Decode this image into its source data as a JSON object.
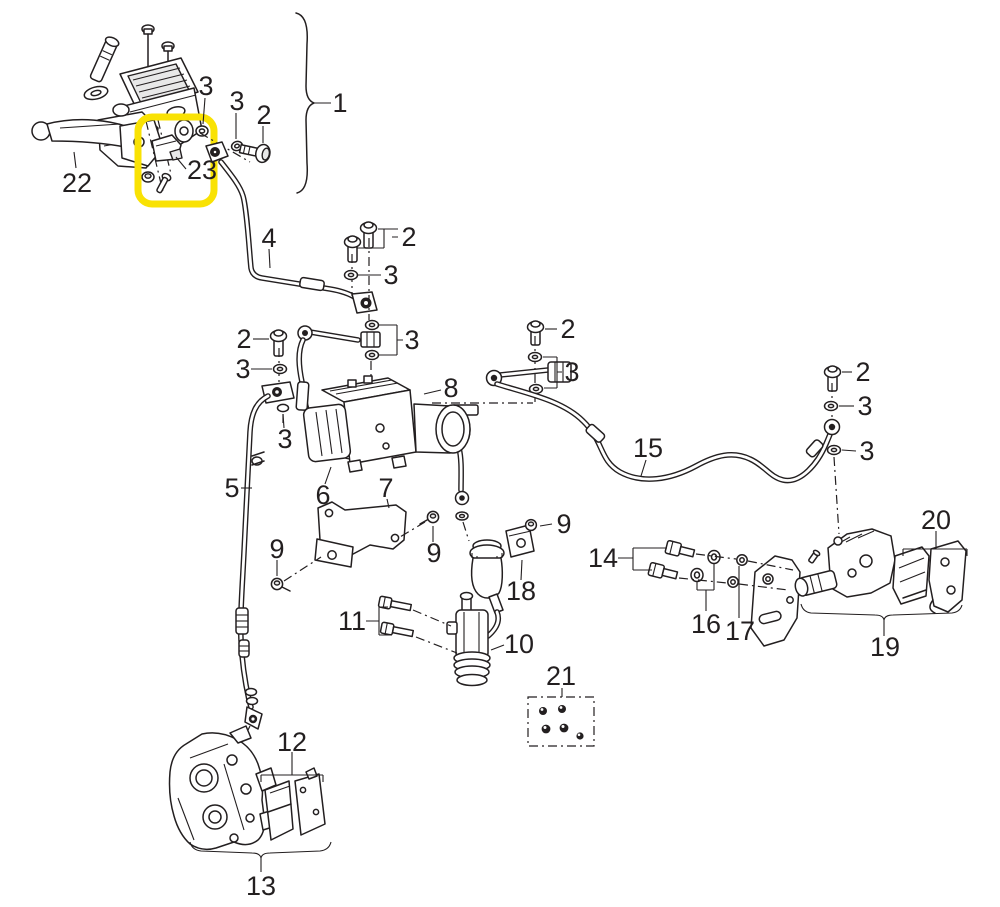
{
  "diagram": {
    "kind": "exploded-parts-diagram",
    "subject": "motorcycle hydraulic brake system with ABS",
    "background_color": "#ffffff",
    "line_color": "#231f20",
    "highlight": {
      "color": "#f9e204",
      "highlighted_part_label": "23",
      "highlighted_part": "brake-light-switch"
    },
    "callouts": [
      {
        "label": "1",
        "part": "front-master-cylinder-assembly"
      },
      {
        "label": "3",
        "part": "sealing-washer"
      },
      {
        "label": "3",
        "part": "sealing-washer"
      },
      {
        "label": "2",
        "part": "banjo-bolt"
      },
      {
        "label": "22",
        "part": "brake-lever"
      },
      {
        "label": "23",
        "part": "brake-light-switch"
      },
      {
        "label": "4",
        "part": "front-brake-hose-upper"
      },
      {
        "label": "2",
        "part": "banjo-bolt-pair"
      },
      {
        "label": "3",
        "part": "sealing-washer"
      },
      {
        "label": "3",
        "part": "sealing-washer-pair"
      },
      {
        "label": "2",
        "part": "banjo-bolt"
      },
      {
        "label": "3",
        "part": "sealing-washer"
      },
      {
        "label": "3",
        "part": "sealing-washer"
      },
      {
        "label": "8",
        "part": "mid-brake-hose"
      },
      {
        "label": "2",
        "part": "banjo-bolt"
      },
      {
        "label": "3",
        "part": "sealing-washer-pair"
      },
      {
        "label": "15",
        "part": "rear-brake-hose"
      },
      {
        "label": "2",
        "part": "banjo-bolt"
      },
      {
        "label": "3",
        "part": "sealing-washer"
      },
      {
        "label": "3",
        "part": "sealing-washer"
      },
      {
        "label": "5",
        "part": "front-brake-hose-lower"
      },
      {
        "label": "6",
        "part": "abs-modulator"
      },
      {
        "label": "7",
        "part": "abs-modulator-bracket"
      },
      {
        "label": "9",
        "part": "screw"
      },
      {
        "label": "9",
        "part": "screw"
      },
      {
        "label": "9",
        "part": "screw"
      },
      {
        "label": "18",
        "part": "reservoir-bracket"
      },
      {
        "label": "10",
        "part": "rear-master-cylinder"
      },
      {
        "label": "11",
        "part": "mounting-bolt-pair"
      },
      {
        "label": "14",
        "part": "caliper-mount-bolt-pair"
      },
      {
        "label": "16",
        "part": "washer-pair"
      },
      {
        "label": "17",
        "part": "nut-pair"
      },
      {
        "label": "19",
        "part": "rear-caliper-assembly"
      },
      {
        "label": "20",
        "part": "rear-brake-pads"
      },
      {
        "label": "21",
        "part": "bleed-cap-kit"
      },
      {
        "label": "12",
        "part": "front-brake-pads"
      },
      {
        "label": "13",
        "part": "front-brake-caliper"
      }
    ]
  }
}
